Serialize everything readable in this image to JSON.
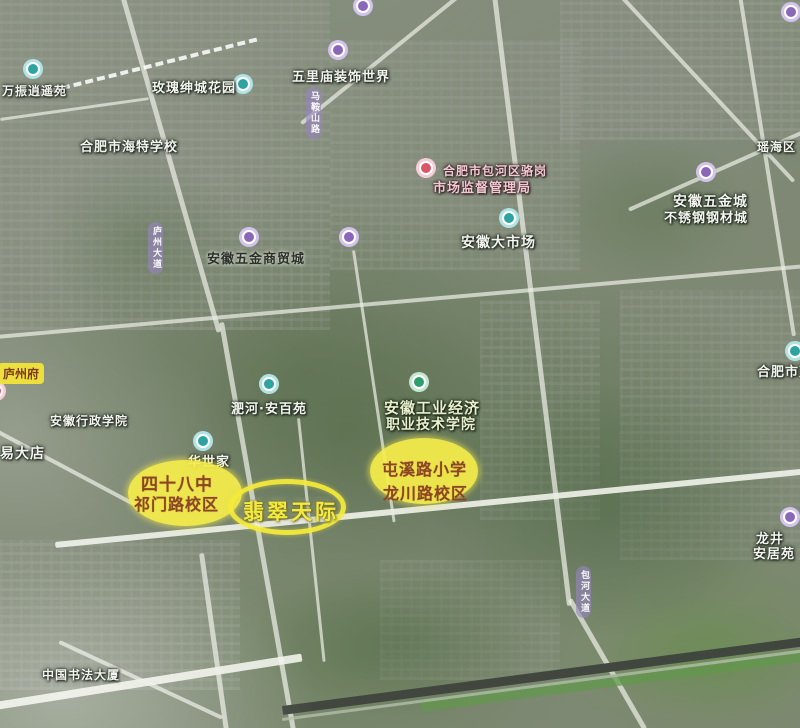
{
  "map": {
    "title": "satellite map of Hefei with highlighted school district annotations",
    "marker_colors": {
      "teal": {
        "ring": "rgba(170,225,228,0.92)",
        "main": "#2fa3a0"
      },
      "purple": {
        "ring": "rgba(205,190,235,0.92)",
        "main": "#8a67b8"
      },
      "red": {
        "ring": "rgba(245,200,210,0.92)",
        "main": "#d85868"
      },
      "green": {
        "ring": "rgba(190,230,205,0.92)",
        "main": "#2f9e6e"
      }
    },
    "annotation_colors": {
      "highlight_fill": "#f5ed4a",
      "highlight_text": "#8d4526",
      "ring_stroke": "#f3ea3a",
      "glow_text": "#f3ea3c"
    },
    "markers": [
      {
        "name": "poi-wanzhen-xiaoyaoyuan",
        "type": "poi",
        "interactable": true,
        "icon": {
          "x": 33,
          "y": 69,
          "color": "teal"
        },
        "text_style": "light",
        "lines": [
          {
            "text": "万振逍遥苑",
            "x": 2,
            "y": 82,
            "size": 12
          }
        ]
      },
      {
        "name": "poi-meigui-shencheng-garden",
        "type": "poi",
        "interactable": true,
        "icon": {
          "x": 243,
          "y": 84,
          "color": "teal"
        },
        "text_style": "light",
        "lines": [
          {
            "text": "玫瑰绅城花园",
            "x": 152,
            "y": 77,
            "size": 13
          }
        ]
      },
      {
        "name": "poi-wulimiao-decoration-world",
        "type": "poi",
        "interactable": true,
        "icon": {
          "x": 338,
          "y": 50,
          "color": "purple"
        },
        "text_style": "light",
        "lines": [
          {
            "text": "五里庙装饰世界",
            "x": 292,
            "y": 66,
            "size": 13
          }
        ]
      },
      {
        "name": "poi-top-edge-marker",
        "type": "poi",
        "interactable": true,
        "icon": {
          "x": 363,
          "y": 6,
          "color": "purple"
        },
        "lines": []
      },
      {
        "name": "poi-topright-corner-marker",
        "type": "poi",
        "interactable": true,
        "icon": {
          "x": 791,
          "y": 12,
          "color": "purple"
        },
        "lines": []
      },
      {
        "name": "label-haite-school",
        "type": "text",
        "interactable": true,
        "text_style": "light",
        "lines": [
          {
            "text": "合肥市海特学校",
            "x": 80,
            "y": 136,
            "size": 13
          }
        ]
      },
      {
        "name": "label-yaohai-district",
        "type": "text",
        "interactable": true,
        "text_style": "light",
        "lines": [
          {
            "text": "瑶海区",
            "x": 757,
            "y": 138,
            "size": 12
          }
        ]
      },
      {
        "name": "poi-wujin-stainless-city",
        "type": "poi",
        "interactable": true,
        "icon": {
          "x": 706,
          "y": 172,
          "color": "purple"
        },
        "text_style": "light",
        "lines": [
          {
            "text": "安徽五金城",
            "x": 673,
            "y": 191,
            "size": 14
          },
          {
            "text": "不锈钢钢材城",
            "x": 664,
            "y": 207,
            "size": 13
          }
        ]
      },
      {
        "name": "poi-market-supervision-bureau",
        "type": "poi",
        "interactable": true,
        "icon": {
          "x": 426,
          "y": 168,
          "color": "red"
        },
        "text_style": "pink",
        "lines": [
          {
            "text": "合肥市包河区骆岗",
            "x": 443,
            "y": 162,
            "size": 12
          },
          {
            "text": "市场监督管理局",
            "x": 433,
            "y": 177,
            "size": 13
          }
        ]
      },
      {
        "name": "poi-anhui-big-market",
        "type": "poi",
        "interactable": true,
        "icon": {
          "x": 509,
          "y": 218,
          "color": "teal"
        },
        "text_style": "light",
        "lines": [
          {
            "text": "安徽大市场",
            "x": 461,
            "y": 232,
            "size": 14
          }
        ]
      },
      {
        "name": "poi-wujin-trade-city",
        "type": "poi",
        "interactable": true,
        "icon": {
          "x": 249,
          "y": 237,
          "color": "purple"
        },
        "text_style": "dark",
        "lines": [
          {
            "text": "安徽五金商贸城",
            "x": 207,
            "y": 248,
            "size": 13
          }
        ]
      },
      {
        "name": "poi-unlabeled-purple-marker",
        "type": "poi",
        "interactable": true,
        "icon": {
          "x": 349,
          "y": 237,
          "color": "purple"
        },
        "lines": []
      },
      {
        "name": "poi-feihe-anbaiyuan",
        "type": "poi",
        "interactable": true,
        "icon": {
          "x": 269,
          "y": 384,
          "color": "teal"
        },
        "text_style": "light",
        "lines": [
          {
            "text": "淝河·安百苑",
            "x": 231,
            "y": 398,
            "size": 13
          }
        ]
      },
      {
        "name": "poi-anhui-industry-economy-college",
        "type": "poi",
        "interactable": true,
        "icon": {
          "x": 419,
          "y": 382,
          "color": "green"
        },
        "text_style": "leafy",
        "lines": [
          {
            "text": "安徽工业经济",
            "x": 384,
            "y": 397,
            "size": 15
          },
          {
            "text": "职业技术学院",
            "x": 386,
            "y": 414,
            "size": 14
          }
        ]
      },
      {
        "name": "badge-luzhoufu",
        "type": "badge",
        "interactable": true,
        "lines": [
          {
            "text": "庐州府",
            "x": -2,
            "y": 363,
            "size": 12
          }
        ]
      },
      {
        "name": "poi-leftedge-red-marker",
        "type": "poi",
        "interactable": true,
        "icon": {
          "x": -4,
          "y": 391,
          "color": "red"
        },
        "lines": []
      },
      {
        "name": "label-administration-institute",
        "type": "text",
        "interactable": true,
        "text_style": "light",
        "lines": [
          {
            "text": "安徽行政学院",
            "x": 50,
            "y": 412,
            "size": 12
          }
        ]
      },
      {
        "name": "poi-huashijia",
        "type": "poi",
        "interactable": true,
        "icon": {
          "x": 203,
          "y": 441,
          "color": "teal"
        },
        "text_style": "light",
        "lines": [
          {
            "text": "华世家",
            "x": 188,
            "y": 451,
            "size": 13
          }
        ]
      },
      {
        "name": "label-yidadian",
        "type": "text",
        "interactable": true,
        "text_style": "light",
        "lines": [
          {
            "text": "易大店",
            "x": 0,
            "y": 443,
            "size": 14
          }
        ]
      },
      {
        "name": "highlight-no48-middle-school",
        "type": "ellipse",
        "interactable": false,
        "ellipse": {
          "cx": 185,
          "cy": 493,
          "rx": 57,
          "ry": 33
        },
        "text_style": "ellipse",
        "lines": [
          {
            "text": "四十八中",
            "x": 141,
            "y": 470,
            "size": 17
          },
          {
            "text": "祁门路校区",
            "x": 134,
            "y": 491,
            "size": 16
          }
        ]
      },
      {
        "name": "highlight-feicui-tianji",
        "type": "ring",
        "interactable": false,
        "ellipse": {
          "cx": 287,
          "cy": 507,
          "rx": 59,
          "ry": 28
        },
        "text_style": "glow",
        "lines": [
          {
            "text": "翡翠天际",
            "x": 243,
            "y": 496,
            "size": 21
          }
        ]
      },
      {
        "name": "highlight-tunxi-road-primary",
        "type": "ellipse",
        "interactable": false,
        "ellipse": {
          "cx": 424,
          "cy": 471,
          "rx": 54,
          "ry": 33
        },
        "text_style": "ellipse",
        "lines": [
          {
            "text": "屯溪路小学",
            "x": 382,
            "y": 456,
            "size": 16
          },
          {
            "text": "龙川路校区",
            "x": 383,
            "y": 480,
            "size": 16
          }
        ]
      },
      {
        "name": "poi-rightedge-hefeishi",
        "type": "poi",
        "interactable": true,
        "icon": {
          "x": 795,
          "y": 351,
          "color": "teal"
        },
        "text_style": "light",
        "lines": [
          {
            "text": "合肥市双",
            "x": 757,
            "y": 361,
            "size": 13
          }
        ]
      },
      {
        "name": "poi-longjing",
        "type": "poi",
        "interactable": true,
        "icon": {
          "x": 790,
          "y": 517,
          "color": "purple"
        },
        "text_style": "light",
        "lines": [
          {
            "text": "龙井",
            "x": 756,
            "y": 528,
            "size": 13
          },
          {
            "text": "安居苑",
            "x": 753,
            "y": 543,
            "size": 13
          }
        ]
      },
      {
        "name": "label-china-calligraphy-building",
        "type": "text",
        "interactable": true,
        "text_style": "light",
        "lines": [
          {
            "text": "中国书法大厦",
            "x": 42,
            "y": 666,
            "size": 12
          }
        ]
      },
      {
        "name": "road-tag-luzhou-avenue",
        "type": "roadtag",
        "interactable": false,
        "lines": [
          {
            "text": "庐州大道",
            "x": 148,
            "y": 222,
            "size": 9
          }
        ]
      },
      {
        "name": "road-tag-maanshan-road",
        "type": "roadtag",
        "interactable": false,
        "lines": [
          {
            "text": "马鞍山路",
            "x": 306,
            "y": 87,
            "size": 9
          }
        ]
      },
      {
        "name": "road-tag-baohe-avenue",
        "type": "roadtag",
        "interactable": false,
        "lines": [
          {
            "text": "包河大道",
            "x": 576,
            "y": 566,
            "size": 9
          }
        ]
      }
    ]
  }
}
